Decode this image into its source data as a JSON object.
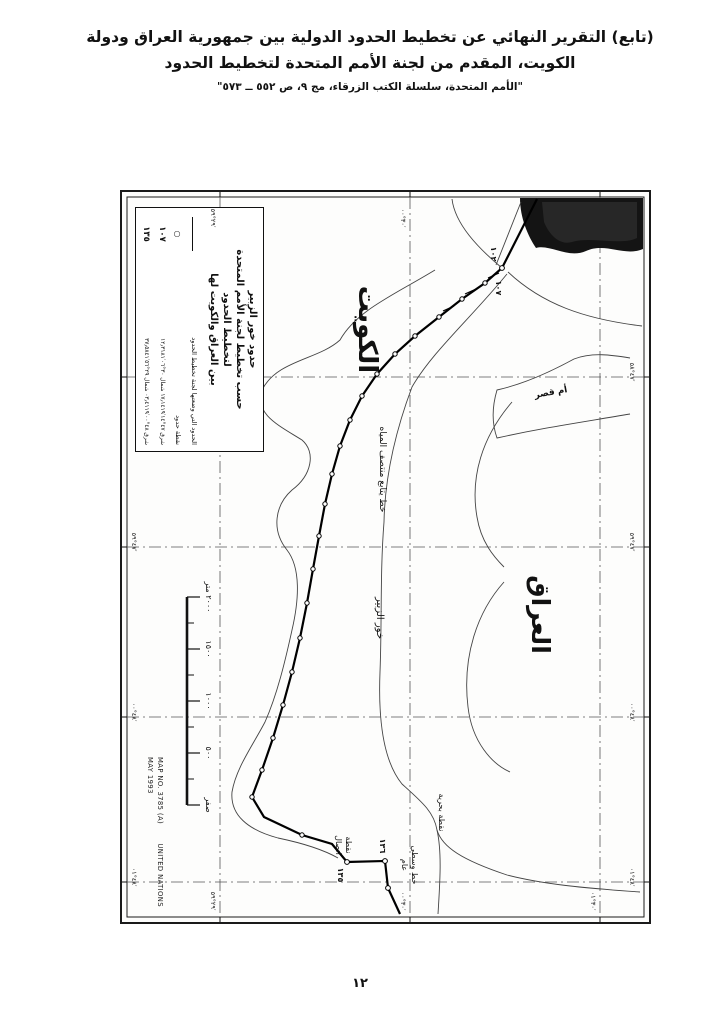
{
  "header": {
    "line1": "(تابع) التقرير النهائي عن تخطيط الحدود الدولية بين جمهورية العراق ودولة",
    "line2": "الكويت، المقدم من لجنة الأمم المتحدة لتخطيط الحدود",
    "line3": "\"الأمم المتحدة، سلسلة الكتب الزرقاء، مج ٩، ص ٥٥٢ ــ ٥٧٣\""
  },
  "map": {
    "legend": {
      "title1": "حدود خور الزبير",
      "title2": "حسب تخطيط لجنة الأمم المتحدة",
      "title3": "لتخطيط الحدود",
      "title4": "بين العراق والكويت لها",
      "row_boundary_label": "الحدود التي وضعتها لجنة تخطيط الحدود",
      "row_point_symbol": "○",
      "row_point_label": "نقطة حدود",
      "row_107_symbol": "١٠٧",
      "row_107_label": "شرق ٤٧°١٤′١٧٫١٤١٩ شمال ٣٠°٠٦′١٢٫٣١٨١",
      "row_135_symbol": "١٣٥",
      "row_135_label": "شرق ٤٨°٠٠′٠٣٫٤١١٩ شمال ٢٩°٥٦′٣٧٫٥٨٤١"
    },
    "labels": {
      "kuwait": "الكويت",
      "iraq": "العراق",
      "khor_zubair": "خور الزبير",
      "thalweg": "خط يتابع منتصف المياه",
      "umm_qasr": "أم قصر",
      "maritime_point": "نقطة بحرية",
      "junction_point_1": "نقطة",
      "junction_point_2": "اتصال",
      "median_1": "خط وسطي",
      "median_2": "عام",
      "pt102": "١٠٢",
      "pt107": "١٠٧",
      "pt135": "١٣٥",
      "pt136": "١٣٦"
    },
    "scale": {
      "s2000": "٢٠٠٠ متر",
      "s1500": "١٥٠٠",
      "s1000": "١٠٠٠",
      "s500": "٥٠٠",
      "s0": "صفر"
    },
    "graticule": {
      "left_59": "٤٧°٥٩′",
      "left_00": "٤٨°٠٠′",
      "left_01": "٤٨°٠١′",
      "right_58": "٤٧°٥٨′",
      "right_59": "٤٧°٥٩′",
      "right_00": "٤٨°٠٠′",
      "right_01": "٤٨°٠١′",
      "top_2959": "٢٩°٥٩′",
      "top_3000": "٣٠°٠٠′",
      "bottom_2959": "٢٩°٥٩′",
      "bottom_3000": "٣٠°٠٠′",
      "bottom_3001": "٣٠°٠١′"
    },
    "credit": {
      "map_no": "MAP NO. 3785 (A)",
      "org": "UNITED NATIONS",
      "date": "MAY 1993"
    }
  },
  "footer": {
    "page_number": "١٢"
  }
}
